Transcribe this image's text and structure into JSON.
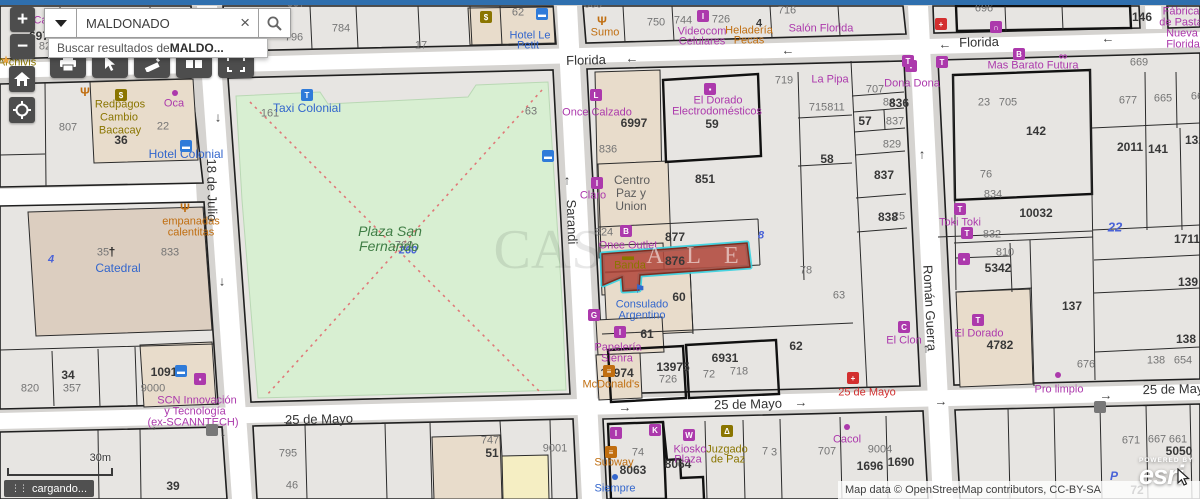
{
  "ui": {
    "topbar_color": "#2f6fae",
    "zoom_in": "+",
    "zoom_out": "−",
    "search": {
      "value": "MALDONADO",
      "clear": "×",
      "suggestion_prefix": "Buscar resultados de ",
      "suggestion_term": "MALDO..."
    },
    "scale_text": "30m",
    "loading_text": "cargando...",
    "attribution": "Map data © OpenStreetMap contributors, CC-BY-SA",
    "powered_by": "POWERED BY",
    "brand": "esri"
  },
  "map": {
    "colors": {
      "shop_purple": "#ac39ac",
      "food_orange": "#c06e10",
      "tourism_blue": "#3366cc",
      "money_khaki": "#8a7500",
      "park_green": "#3f7d45",
      "street_text": "#333333",
      "plaza_fill": "#d8efd2",
      "building_beige": "#e8dccb",
      "pharmacy_red": "#d32f2f",
      "highlight_fill": "#b2493c",
      "highlight_outline": "#35d0e0",
      "bus_red": "#d03030",
      "parcel_blue": "#4a63d8"
    },
    "labels": [
      [
        "Florida",
        586,
        60,
        "st",
        -1.5
      ],
      [
        "Florida",
        979,
        42,
        "st",
        -1.5
      ],
      [
        "25 de Mayo",
        319,
        419,
        "st",
        -1.3
      ],
      [
        "25 de Mayo",
        748,
        404,
        "st",
        -1.3
      ],
      [
        "25 de May",
        1173,
        389,
        "st",
        -1.3
      ],
      [
        "18 de Julio",
        212,
        190,
        "st",
        89
      ],
      [
        "Sarandi",
        572,
        222,
        "st",
        88
      ],
      [
        "Román Guerra",
        930,
        308,
        "st",
        87
      ],
      [
        "←",
        632,
        58,
        "ar"
      ],
      [
        "←",
        788,
        50,
        "ar"
      ],
      [
        "←",
        945,
        44,
        "ar"
      ],
      [
        "←",
        1108,
        38,
        "ar"
      ],
      [
        "→",
        288,
        420,
        "ar"
      ],
      [
        "→",
        625,
        407,
        "ar"
      ],
      [
        "→",
        801,
        402,
        "ar"
      ],
      [
        "→",
        941,
        401,
        "ar"
      ],
      [
        "→",
        1106,
        395,
        "ar"
      ],
      [
        "→",
        152,
        426,
        "ar"
      ],
      [
        "↓",
        218,
        117,
        "ar"
      ],
      [
        "↓",
        222,
        281,
        "ar"
      ],
      [
        "↑",
        567,
        180,
        "ar"
      ],
      [
        "↑",
        922,
        154,
        "ar"
      ],
      [
        "↑",
        926,
        348,
        "ar"
      ],
      [
        "↓",
        223,
        432,
        "ar"
      ],
      [
        "828",
        48,
        47,
        "n"
      ],
      [
        "857",
        296,
        4,
        "n"
      ],
      [
        "796",
        294,
        38,
        "n"
      ],
      [
        "784",
        341,
        29,
        "n"
      ],
      [
        "62",
        518,
        13,
        "n"
      ],
      [
        "17",
        421,
        46,
        "n"
      ],
      [
        "860",
        593,
        5,
        "n"
      ],
      [
        "750",
        656,
        23,
        "n"
      ],
      [
        "744",
        683,
        21,
        "n"
      ],
      [
        "726",
        721,
        20,
        "n"
      ],
      [
        "716",
        787,
        11,
        "n"
      ],
      [
        "696",
        984,
        9,
        "n"
      ],
      [
        "669",
        1139,
        63,
        "n"
      ],
      [
        "23",
        984,
        103,
        "n"
      ],
      [
        "705",
        1008,
        103,
        "n"
      ],
      [
        "677",
        1128,
        101,
        "n"
      ],
      [
        "665",
        1163,
        99,
        "n"
      ],
      [
        "66",
        1197,
        97,
        "n"
      ],
      [
        "161",
        270,
        114,
        "n"
      ],
      [
        "63",
        531,
        112,
        "n"
      ],
      [
        "807",
        68,
        128,
        "n"
      ],
      [
        "22",
        163,
        127,
        "n"
      ],
      [
        "836",
        608,
        150,
        "n"
      ],
      [
        "719",
        784,
        81,
        "n"
      ],
      [
        "715",
        818,
        108,
        "n"
      ],
      [
        "811",
        836,
        108,
        "n"
      ],
      [
        "707",
        875,
        90,
        "n"
      ],
      [
        "84",
        889,
        103,
        "n"
      ],
      [
        "837",
        895,
        122,
        "n"
      ],
      [
        "829",
        892,
        145,
        "n"
      ],
      [
        "25",
        899,
        217,
        "n"
      ],
      [
        "824",
        604,
        233,
        "n"
      ],
      [
        "35",
        103,
        253,
        "n"
      ],
      [
        "833",
        170,
        253,
        "n"
      ],
      [
        "760",
        404,
        246,
        "n"
      ],
      [
        "78",
        806,
        271,
        "n"
      ],
      [
        "63",
        839,
        296,
        "n"
      ],
      [
        "834",
        993,
        195,
        "n"
      ],
      [
        "76",
        986,
        175,
        "n"
      ],
      [
        "832",
        992,
        235,
        "n"
      ],
      [
        "810",
        1005,
        253,
        "n"
      ],
      [
        "718",
        739,
        372,
        "n"
      ],
      [
        "726",
        668,
        380,
        "n"
      ],
      [
        "72",
        709,
        375,
        "n"
      ],
      [
        "676",
        1086,
        365,
        "n"
      ],
      [
        "138",
        1156,
        361,
        "n"
      ],
      [
        "654",
        1183,
        361,
        "n"
      ],
      [
        "671",
        1131,
        441,
        "n"
      ],
      [
        "667",
        1157,
        440,
        "n"
      ],
      [
        "661",
        1178,
        440,
        "n"
      ],
      [
        "795",
        288,
        454,
        "n"
      ],
      [
        "747",
        490,
        441,
        "n"
      ],
      [
        "9001",
        555,
        449,
        "n"
      ],
      [
        "46",
        292,
        486,
        "n"
      ],
      [
        "357",
        72,
        389,
        "n"
      ],
      [
        "820",
        30,
        389,
        "n"
      ],
      [
        "9000",
        153,
        389,
        "n"
      ],
      [
        "707",
        827,
        452,
        "n"
      ],
      [
        "9004",
        880,
        450,
        "n"
      ],
      [
        "74",
        638,
        453,
        "n"
      ],
      [
        "7",
        765,
        452,
        "n"
      ],
      [
        "3",
        774,
        453,
        "n"
      ],
      [
        "697",
        39,
        36,
        "nb"
      ],
      [
        "36",
        121,
        140,
        "nb"
      ],
      [
        "34",
        68,
        375,
        "nb"
      ],
      [
        "1091",
        164,
        372,
        "nb"
      ],
      [
        "6997",
        634,
        123,
        "nb"
      ],
      [
        "59",
        712,
        124,
        "nb"
      ],
      [
        "851",
        705,
        179,
        "nb"
      ],
      [
        "58",
        827,
        159,
        "nb"
      ],
      [
        "57",
        865,
        121,
        "nb"
      ],
      [
        "836",
        899,
        103,
        "nb"
      ],
      [
        "837",
        884,
        175,
        "nb"
      ],
      [
        "838",
        888,
        217,
        "nb"
      ],
      [
        "877",
        675,
        237,
        "nb"
      ],
      [
        "876",
        675,
        261,
        "nb"
      ],
      [
        "60",
        679,
        297,
        "nb"
      ],
      [
        "61",
        647,
        334,
        "nb"
      ],
      [
        "13974",
        617,
        373,
        "nb"
      ],
      [
        "13975",
        673,
        367,
        "nb"
      ],
      [
        "6931",
        725,
        358,
        "nb"
      ],
      [
        "62",
        796,
        346,
        "nb"
      ],
      [
        "4",
        759,
        24,
        "nb",
        0,
        11
      ],
      [
        "142",
        1036,
        131,
        "nb"
      ],
      [
        "2011",
        1130,
        147,
        "nb"
      ],
      [
        "141",
        1158,
        149,
        "nb"
      ],
      [
        "132",
        1195,
        140,
        "nb"
      ],
      [
        "10032",
        1036,
        213,
        "nb"
      ],
      [
        "5342",
        998,
        268,
        "nb"
      ],
      [
        "1711",
        1187,
        239,
        "nb"
      ],
      [
        "139",
        1188,
        282,
        "nb"
      ],
      [
        "137",
        1072,
        306,
        "nb"
      ],
      [
        "138",
        1186,
        339,
        "nb"
      ],
      [
        "4782",
        1000,
        345,
        "nb"
      ],
      [
        "5050",
        1179,
        451,
        "nb"
      ],
      [
        "8063",
        633,
        470,
        "nb"
      ],
      [
        "8064",
        678,
        464,
        "nb"
      ],
      [
        "1696",
        870,
        466,
        "nb"
      ],
      [
        "1690",
        901,
        462,
        "nb"
      ],
      [
        "51",
        492,
        453,
        "nb"
      ],
      [
        "39",
        173,
        486,
        "nb"
      ],
      [
        "146",
        1142,
        17,
        "nb"
      ],
      [
        "72",
        1137,
        490,
        "nb"
      ],
      [
        "4",
        51,
        260,
        "nbl"
      ],
      [
        "260",
        408,
        251,
        "nbl"
      ],
      [
        "8",
        761,
        236,
        "nbl"
      ],
      [
        "22",
        1115,
        227,
        "nbl",
        0,
        13
      ],
      [
        "P",
        1114,
        476,
        "nbl",
        0,
        12
      ],
      [
        "Cat",
        42,
        21,
        "pp"
      ],
      [
        "Oca",
        174,
        104,
        "pp"
      ],
      [
        "Videocom",
        702,
        32,
        "pp"
      ],
      [
        "Celulares",
        702,
        42,
        "pp"
      ],
      [
        "Salón Florida",
        821,
        29,
        "pp"
      ],
      [
        "Fábrica",
        1181,
        12,
        "pp"
      ],
      [
        "de Pasta",
        1181,
        23,
        "pp"
      ],
      [
        "Nueva",
        1182,
        34,
        "pp"
      ],
      [
        "Florida",
        1183,
        45,
        "pp"
      ],
      [
        "Mas Barato Futura",
        1033,
        66,
        "pp"
      ],
      [
        "Dona Dona",
        912,
        84,
        "pp"
      ],
      [
        "Once Calzado",
        597,
        113,
        "pp"
      ],
      [
        "El Dorado",
        718,
        101,
        "pp"
      ],
      [
        "Electrodomésticos",
        717,
        112,
        "pp"
      ],
      [
        "La Pipa",
        830,
        80,
        "pp"
      ],
      [
        "Claro",
        593,
        196,
        "pp"
      ],
      [
        "Once Outlet",
        628,
        246,
        "pp"
      ],
      [
        "Toki Toki",
        960,
        223,
        "pp"
      ],
      [
        "El Dorado",
        979,
        334,
        "pp"
      ],
      [
        "Pro limpio",
        1059,
        390,
        "pp"
      ],
      [
        "El Clon",
        904,
        341,
        "pp"
      ],
      [
        "Cacol",
        847,
        440,
        "pp"
      ],
      [
        "Kiosko",
        690,
        450,
        "pp"
      ],
      [
        "Plaza",
        688,
        460,
        "pp"
      ],
      [
        "SCN Innovación",
        197,
        401,
        "pp"
      ],
      [
        "y Tecnología",
        195,
        412,
        "pp"
      ],
      [
        "(ex-SCANNTECH)",
        193,
        423,
        "pp"
      ],
      [
        "Papelería",
        618,
        348,
        "pp"
      ],
      [
        "Sienra",
        617,
        359,
        "pp"
      ],
      [
        "Sumo",
        605,
        33,
        "po"
      ],
      [
        "Heladería",
        749,
        31,
        "po"
      ],
      [
        "Pecas",
        749,
        41,
        "po"
      ],
      [
        "empanadas",
        191,
        222,
        "po"
      ],
      [
        "calentitas",
        191,
        233,
        "po"
      ],
      [
        "McDonald's",
        611,
        385,
        "po"
      ],
      [
        "Subway",
        614,
        463,
        "po"
      ],
      [
        "Taxi Colonial",
        307,
        108,
        "pb",
        0,
        12
      ],
      [
        "Hotel Colonial",
        186,
        154,
        "pb",
        0,
        12
      ],
      [
        "Hotel Le",
        530,
        36,
        "pb"
      ],
      [
        "Petit",
        528,
        46,
        "pb"
      ],
      [
        "Catedral",
        118,
        268,
        "pb",
        0,
        12
      ],
      [
        "Consulado",
        642,
        305,
        "pb"
      ],
      [
        "Argentino",
        642,
        316,
        "pb"
      ],
      [
        "Siempre",
        615,
        489,
        "pb"
      ],
      [
        "Redpagos",
        120,
        105,
        "pk"
      ],
      [
        "Cambio",
        119,
        118,
        "pk"
      ],
      [
        "Bacacay",
        120,
        131,
        "pk"
      ],
      [
        "Banda",
        630,
        266,
        "pk"
      ],
      [
        "Juzgado",
        727,
        450,
        "pk"
      ],
      [
        "de Paz",
        728,
        460,
        "pk"
      ],
      [
        "Archivis",
        17,
        63,
        "pk"
      ],
      [
        "Centro",
        632,
        180,
        "pg"
      ],
      [
        "Paz y",
        631,
        193,
        "pg"
      ],
      [
        "Union",
        631,
        206,
        "pg"
      ],
      [
        "Plaza San",
        390,
        231,
        "pgr"
      ],
      [
        "Fernando",
        389,
        246,
        "pgr"
      ],
      [
        "25 de Mayo",
        867,
        393,
        "pr"
      ],
      [
        "CAS",
        548,
        250,
        "wm"
      ],
      [
        "A L E",
        697,
        256,
        "wm2"
      ]
    ],
    "icons": [
      [
        "star",
        6,
        60,
        "★",
        "",
        "#e8a33d"
      ],
      [
        "money-exchange",
        121,
        95,
        "$",
        "#8a7500",
        ""
      ],
      [
        "money-exchange",
        486,
        17,
        "$",
        "#8a7500",
        ""
      ],
      [
        "restaurant",
        85,
        92,
        "Ψ",
        "",
        "#c06e10"
      ],
      [
        "restaurant",
        185,
        208,
        "Ψ",
        "",
        "#c06e10"
      ],
      [
        "restaurant",
        602,
        21,
        "Ψ",
        "",
        "#c06e10"
      ],
      [
        "poi-dot",
        175,
        93,
        "dot",
        "",
        "#ac39ac"
      ],
      [
        "hotel-bed",
        186,
        146,
        "▬",
        "#2f7bd9",
        ""
      ],
      [
        "hotel-bed",
        542,
        14,
        "▬",
        "#2f7bd9",
        ""
      ],
      [
        "hotel-bed",
        181,
        371,
        "▬",
        "#2f7bd9",
        ""
      ],
      [
        "church-cross",
        112,
        252,
        "†",
        "",
        "#222222"
      ],
      [
        "computer",
        200,
        379,
        "▪",
        "#ac39ac",
        ""
      ],
      [
        "computer",
        964,
        259,
        "▪",
        "#ac39ac",
        ""
      ],
      [
        "taxi",
        307,
        95,
        "T",
        "#2f7bd9",
        ""
      ],
      [
        "car",
        548,
        156,
        "▬",
        "#2f7bd9",
        ""
      ],
      [
        "phone",
        703,
        16,
        "I",
        "#ac39ac",
        ""
      ],
      [
        "phone",
        597,
        183,
        "I",
        "#ac39ac",
        ""
      ],
      [
        "phone",
        616,
        433,
        "I",
        "#ac39ac",
        ""
      ],
      [
        "tv",
        710,
        89,
        "▪",
        "#ac39ac",
        ""
      ],
      [
        "shoe-shop",
        596,
        95,
        "L",
        "#ac39ac",
        ""
      ],
      [
        "shop-bag",
        626,
        231,
        "B",
        "#ac39ac",
        ""
      ],
      [
        "gift-shop",
        594,
        315,
        "G",
        "#ac39ac",
        ""
      ],
      [
        "flag-consulate",
        640,
        289,
        "⚑",
        "",
        "#3366cc"
      ],
      [
        "tool",
        628,
        256,
        "▬",
        "",
        "#8a7500"
      ],
      [
        "paperclip",
        620,
        332,
        "l",
        "#ac39ac",
        ""
      ],
      [
        "fast-food",
        609,
        371,
        "≡",
        "#c06e10",
        ""
      ],
      [
        "fast-food",
        611,
        452,
        "≡",
        "#c06e10",
        ""
      ],
      [
        "scales-justice",
        727,
        431,
        "Δ",
        "#8a7500",
        ""
      ],
      [
        "kiosk",
        655,
        430,
        "K",
        "#ac39ac",
        ""
      ],
      [
        "window-shop",
        689,
        435,
        "W",
        "#ac39ac",
        ""
      ],
      [
        "dress-shop",
        911,
        66,
        "▼",
        "#ac39ac",
        ""
      ],
      [
        "shirt-shop",
        908,
        61,
        "T",
        "#ac39ac",
        ""
      ],
      [
        "shirt-shop",
        942,
        62,
        "T",
        "#ac39ac",
        ""
      ],
      [
        "shirt-shop",
        960,
        209,
        "T",
        "#ac39ac",
        ""
      ],
      [
        "shirt-shop",
        967,
        233,
        "T",
        "#ac39ac",
        ""
      ],
      [
        "shirt-shop",
        978,
        320,
        "T",
        "#ac39ac",
        ""
      ],
      [
        "awning",
        996,
        27,
        "∩",
        "#ac39ac",
        ""
      ],
      [
        "shop-bag",
        1019,
        54,
        "B",
        "#ac39ac",
        ""
      ],
      [
        "glasses",
        1063,
        56,
        "∞",
        "",
        "#ac39ac"
      ],
      [
        "cart",
        904,
        327,
        "C",
        "#ac39ac",
        ""
      ],
      [
        "pharmacy",
        941,
        24,
        "+",
        "#d32f2f",
        ""
      ],
      [
        "pharmacy",
        853,
        378,
        "+",
        "#d32f2f",
        ""
      ],
      [
        "poi-dot",
        847,
        427,
        "dot",
        "",
        "#ac39ac"
      ],
      [
        "poi-dot",
        1058,
        375,
        "dot",
        "",
        "#ac39ac"
      ],
      [
        "poi-dot",
        615,
        477,
        "dot",
        "",
        "#3366cc"
      ],
      [
        "trash",
        212,
        430,
        "",
        "#787878",
        ""
      ],
      [
        "trash",
        1100,
        407,
        "",
        "#787878",
        ""
      ]
    ]
  }
}
